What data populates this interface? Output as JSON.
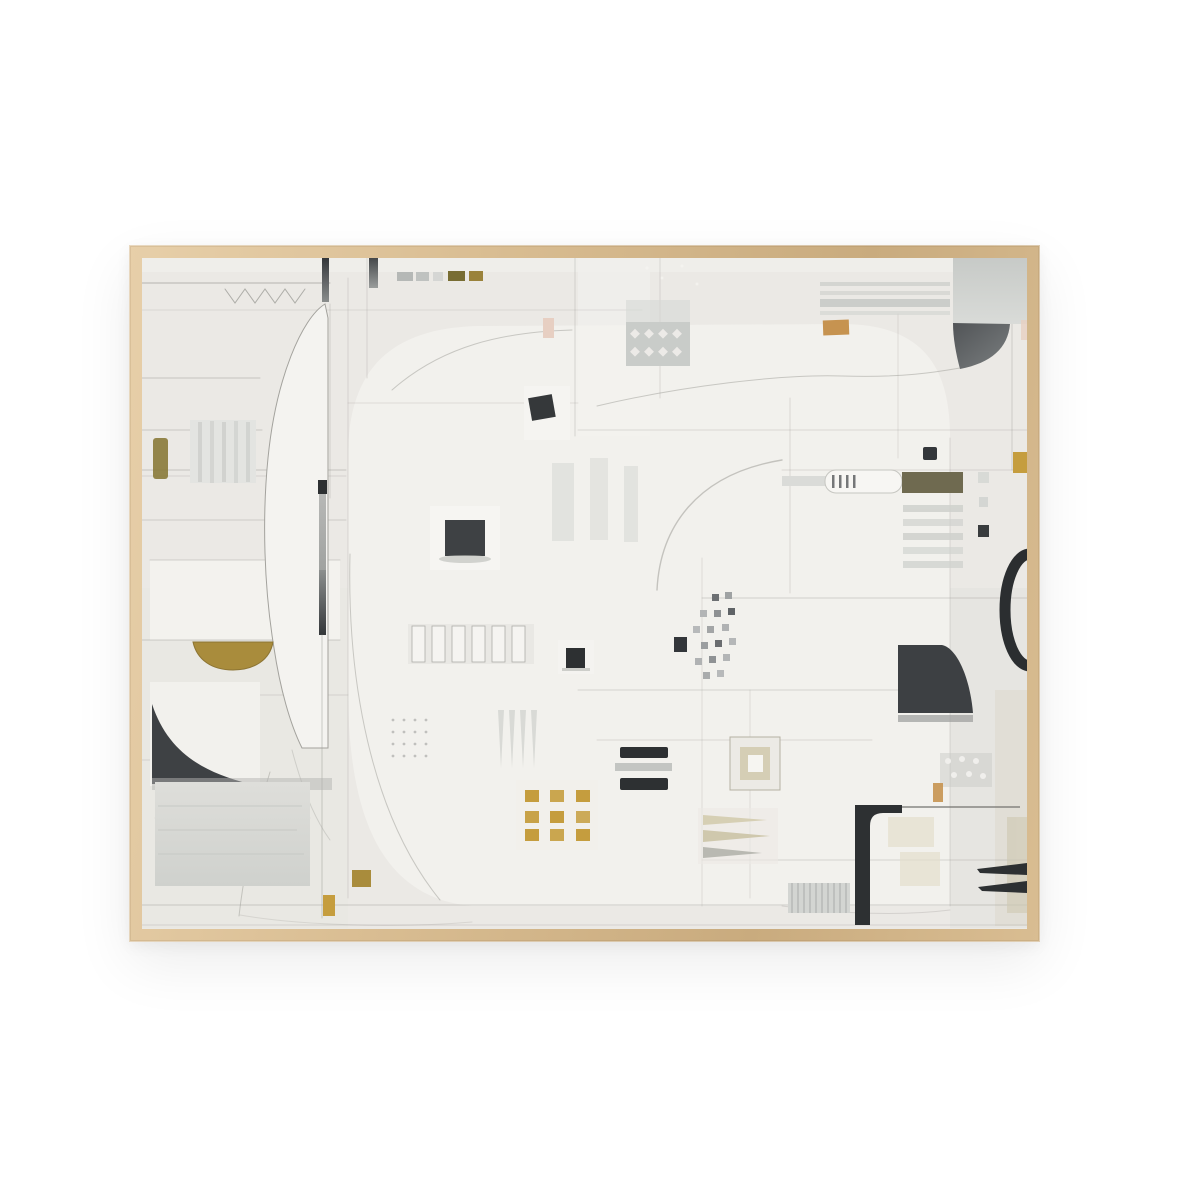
{
  "meta": {
    "type": "product-photo",
    "subject": "framed abstract painting hung on a plain white wall"
  },
  "artwork": {
    "aria_label": "Framed abstract mixed-media painting in neutral whites and soft grays, composed of patchwork blocks, thin pencil lines and large arcing curves, accented with small charcoal-black squares and bars, ochre-gold marks (a gold half-moon bowl, a grid of small gold squares), olive and tan chips, a black ring arc at the right edge and a black rounded corner bracket near the bottom right, all inside a thin light-oak wood frame",
    "orientation": "landscape"
  },
  "palette": {
    "page-bg": "#ffffff",
    "wood-light": "#e7cfa9",
    "wood-mid": "#d9bd92",
    "wood-dark": "#c9ab7e",
    "canvas-base": "#ebe9e5",
    "canvas-light": "#f4f3f0",
    "pencil": "#9e9d98",
    "charcoal": "#3e4144",
    "ink-black": "#2d3032",
    "gold": "#a98c3c",
    "gold-bright": "#c59d3e",
    "olive": "#6f6a50",
    "tan": "#c69350",
    "blush": "#e7cfc2",
    "gray-block": "#c9ccc9",
    "gray-stripe": "#cfd1cd"
  }
}
